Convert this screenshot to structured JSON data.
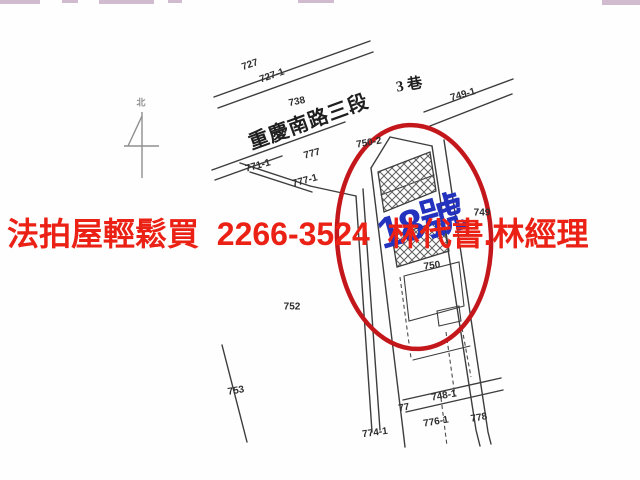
{
  "meta": {
    "width": 640,
    "height": 480,
    "background": "#fefefe"
  },
  "banner": {
    "text": "法拍屋輕鬆買  2266-3524  林代書.林經理",
    "color": "#ea2114"
  },
  "highlight": {
    "house_number": "18號",
    "house_number_color": "#2433be",
    "circle_color": "#c4171c"
  },
  "map": {
    "road_name": "重慶南路三段",
    "lane_label": "3 巷",
    "north_label": "北",
    "line_color": "#3d3d3d",
    "labels": [
      {
        "t": "727",
        "x": 250,
        "y": 65,
        "r": -19
      },
      {
        "t": "727-1",
        "x": 272,
        "y": 76,
        "r": -19
      },
      {
        "t": "738",
        "x": 297,
        "y": 102,
        "r": -12
      },
      {
        "t": "777",
        "x": 312,
        "y": 154,
        "r": -15
      },
      {
        "t": "771-1",
        "x": 258,
        "y": 166,
        "r": -15
      },
      {
        "t": "777-1",
        "x": 305,
        "y": 181,
        "r": -15
      },
      {
        "t": "749-1",
        "x": 463,
        "y": 95,
        "r": -16
      },
      {
        "t": "750-2",
        "x": 369,
        "y": 143,
        "r": -10
      },
      {
        "t": "749",
        "x": 482,
        "y": 213,
        "r": 0
      },
      {
        "t": "750",
        "x": 432,
        "y": 266,
        "r": -8
      },
      {
        "t": "752",
        "x": 292,
        "y": 307,
        "r": 0
      },
      {
        "t": "753",
        "x": 236,
        "y": 391,
        "r": -10
      },
      {
        "t": "774-1",
        "x": 375,
        "y": 433,
        "r": -8
      },
      {
        "t": "748-1",
        "x": 444,
        "y": 396,
        "r": -10
      },
      {
        "t": "77",
        "x": 404,
        "y": 408,
        "r": -10
      },
      {
        "t": "776-1",
        "x": 436,
        "y": 422,
        "r": -10
      },
      {
        "t": "778",
        "x": 479,
        "y": 418,
        "r": -10
      }
    ]
  }
}
